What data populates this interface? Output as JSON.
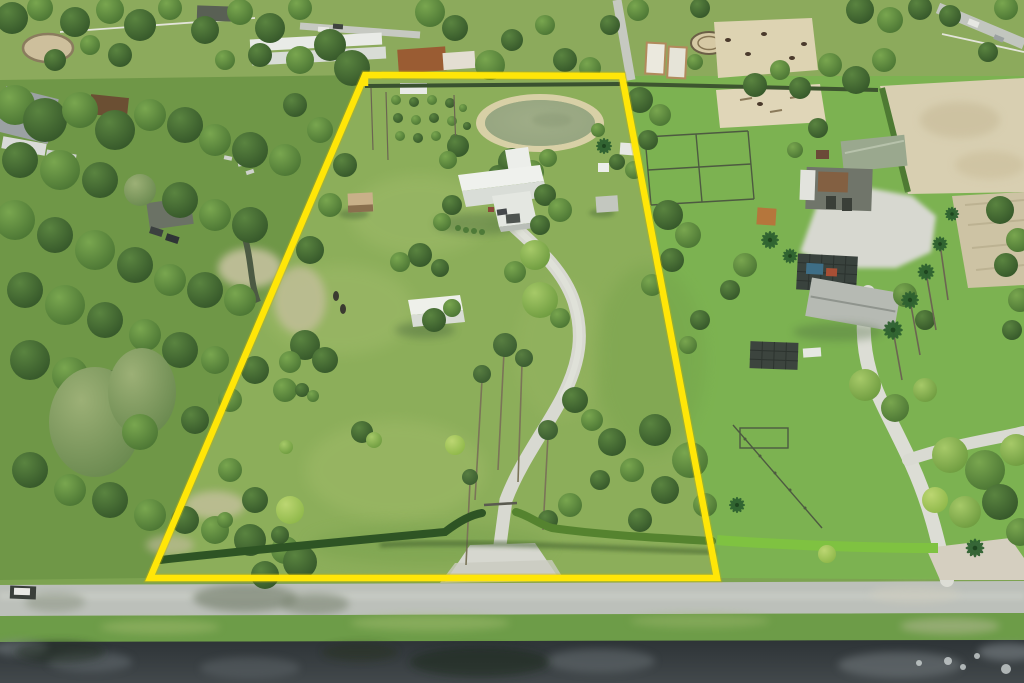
{
  "scene": {
    "type": "aerial-drone-photograph",
    "description": "Aerial drone photo of a rural lot outlined with a bright yellow property-boundary overlay. Inside the boundary: a pond with sandy rim, a white hip-roof house with gravel driveway and gate, a white field shed, a small brown shed, orchard rows, pines and a perimeter hedge. A gray road and a dark drainage canal run along the bottom. Left neighbor is densely wooded; top neighbors have barns, a greenhouse, round pens and sand horse paddocks; right neighbor is an equestrian farm with barns, arenas, a screened pool and palm-lined drive.",
    "boundary": {
      "shape": "quadrilateral",
      "color": "#ffe608",
      "corners_px": [
        [
          365,
          75
        ],
        [
          622,
          76
        ],
        [
          717,
          578
        ],
        [
          150,
          578
        ]
      ]
    },
    "property": {
      "grass_color": "#8cae5a",
      "features": [
        "pond",
        "house with white hip roof",
        "gravel driveway with gate",
        "white field shed",
        "brown shed",
        "orchard rows",
        "pine trees",
        "perimeter hedge",
        "two grazing animals"
      ]
    },
    "pond": {
      "water_color": "#97a681",
      "rim_color": "#d8d0a6"
    },
    "road": {
      "color": "#bcc0ba",
      "position": "bottom, horizontal"
    },
    "canal": {
      "water_color": "#353b3e",
      "position": "bottom edge, horizontal"
    },
    "neighbors": {
      "left": "dense wooded lot, dark-roof shed, parked cars, sandy clearings",
      "top": "farms with gray warehouse, white greenhouse roofs, rust-roof house, tan barns, round pens, sand paddocks with horses",
      "right": "equestrian farm: green-roof barn, rust flat-roof stable, screened pool with blue water, long gray-roof house, royal palms, curved white drive, sand fields"
    }
  }
}
